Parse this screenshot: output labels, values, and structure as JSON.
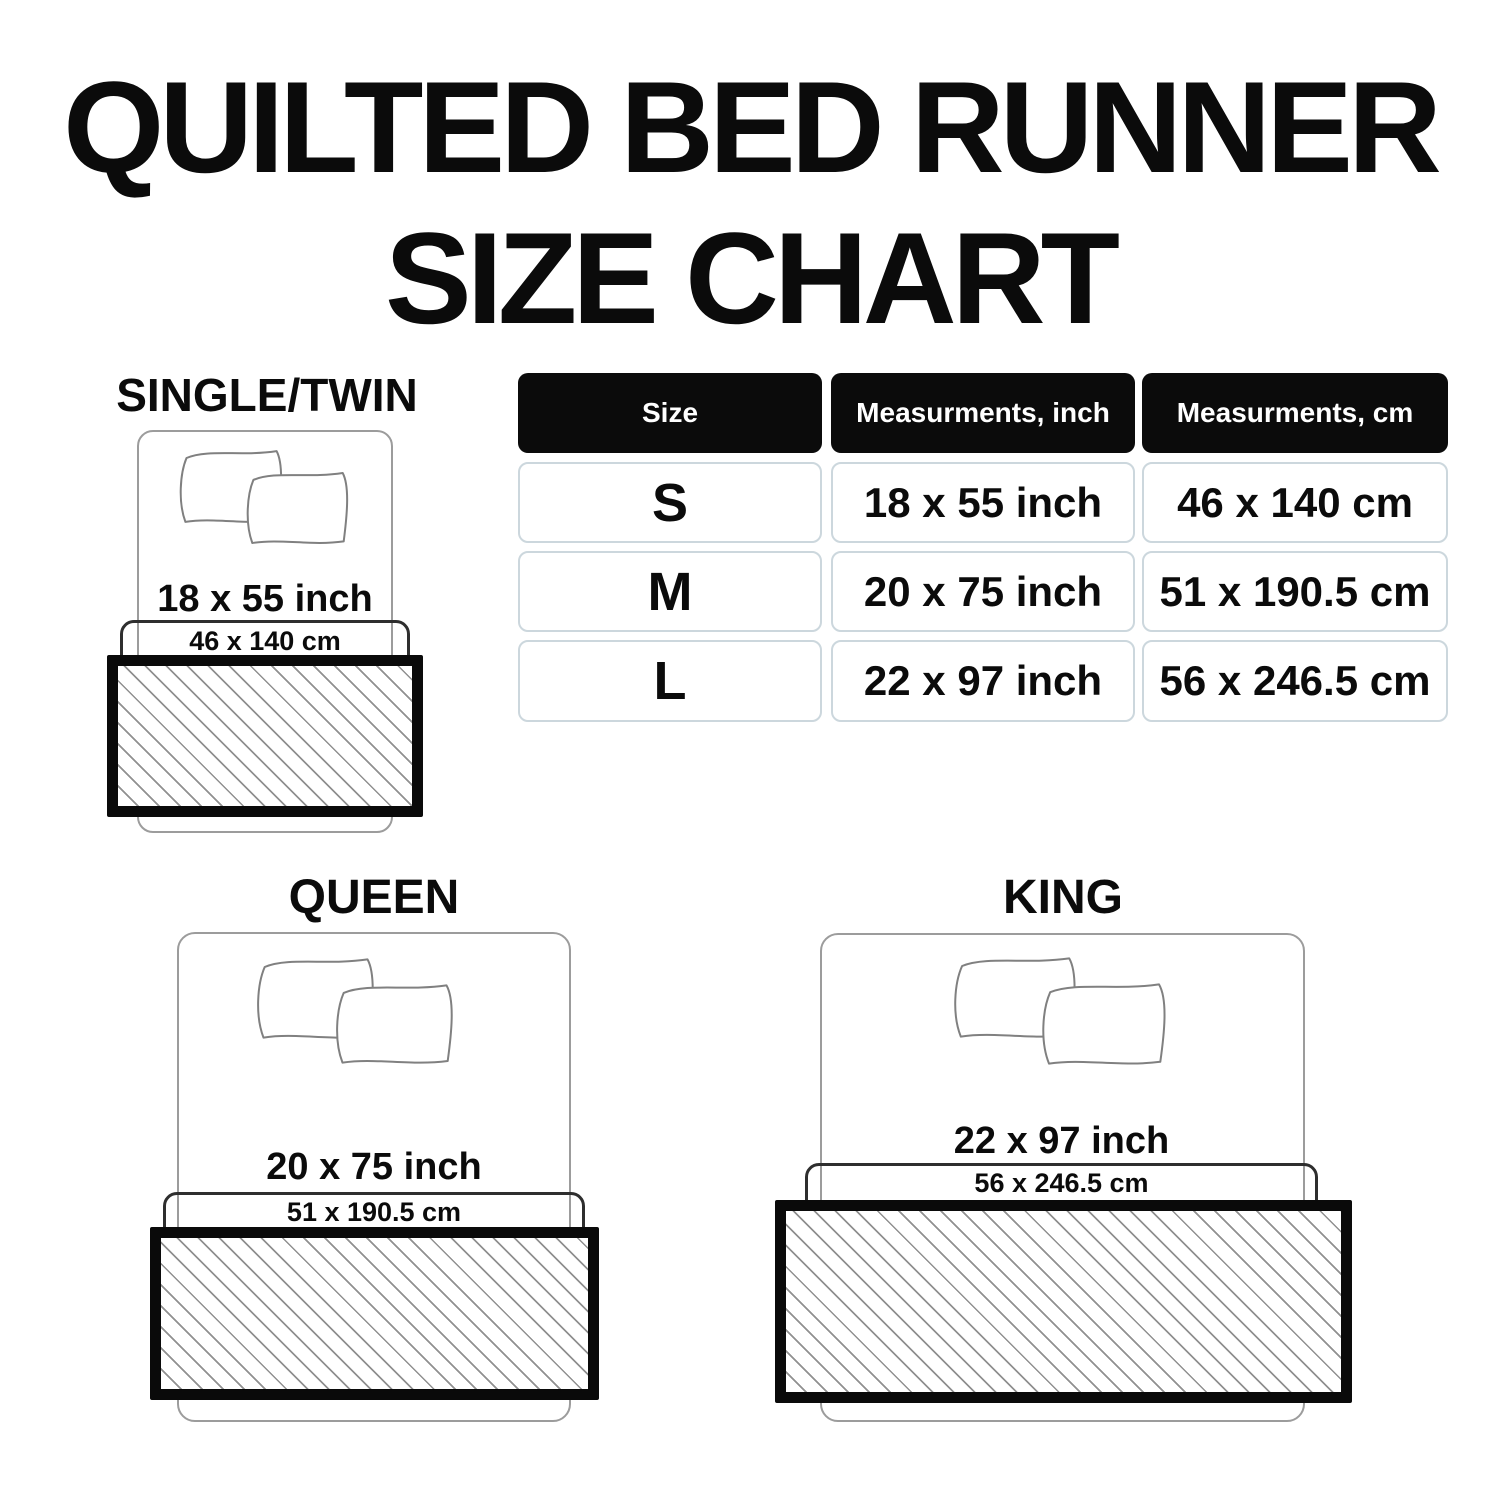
{
  "title": {
    "line1": "QUILTED BED RUNNER",
    "line2": "SIZE CHART"
  },
  "table": {
    "headers": [
      "Size",
      "Measurments, inch",
      "Measurments, cm"
    ],
    "rows": [
      {
        "size": "S",
        "inch": "18 x 55 inch",
        "cm": "46 x 140 cm"
      },
      {
        "size": "M",
        "inch": "20 x 75 inch",
        "cm": "51 x 190.5 cm"
      },
      {
        "size": "L",
        "inch": "22 x 97 inch",
        "cm": "56 x 246.5 cm"
      }
    ]
  },
  "diagrams": {
    "single": {
      "title": "SINGLE/TWIN",
      "inch": "18 x 55 inch",
      "cm": "46 x 140 cm"
    },
    "queen": {
      "title": "QUEEN",
      "inch": "20 x 75 inch",
      "cm": "51 x 190.5 cm"
    },
    "king": {
      "title": "KING",
      "inch": "22 x 97 inch",
      "cm": "56 x 246.5 cm"
    }
  },
  "colors": {
    "text": "#0b0b0b",
    "header_bg": "#0b0b0b",
    "header_text": "#ffffff",
    "cell_border": "#ccd7dd",
    "bed_outline": "#9c9c9c",
    "drape_outline": "#2e2e2e",
    "hatch_line": "#909090",
    "runner_border": "#0a0a0a",
    "background": "#ffffff"
  }
}
